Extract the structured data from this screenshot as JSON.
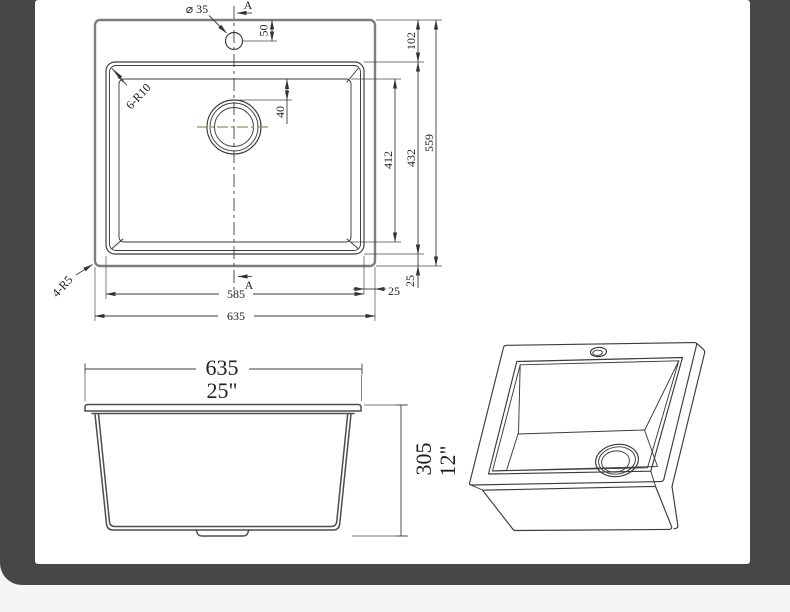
{
  "page": {
    "background": "#f4f5f4",
    "frame_color": "#474747",
    "canvas_color": "#ffffff",
    "line_color": "#3b3b3b",
    "centerline_color": "#9c8b63"
  },
  "drawing": {
    "type": "technical-drawing",
    "subject": "drop-in kitchen sink, three views",
    "views": {
      "plan": {
        "dims": {
          "faucet_diameter": "⌀ 35",
          "section_label": "A",
          "faucet_offset": "50",
          "top_margin": "102",
          "bowl_floor_depth": "412",
          "bowl_depth": "432",
          "overall_depth": "559",
          "drain_offset": "40",
          "bowl_width": "585",
          "overall_width": "635",
          "margin_right": "25",
          "margin_bottom": "25",
          "inner_corner_radius": "6-R10",
          "outer_corner_radius": "4-R5"
        }
      },
      "front": {
        "width_mm": "635",
        "width_in": "25\"",
        "height_mm": "305",
        "height_in": "12\""
      }
    }
  }
}
